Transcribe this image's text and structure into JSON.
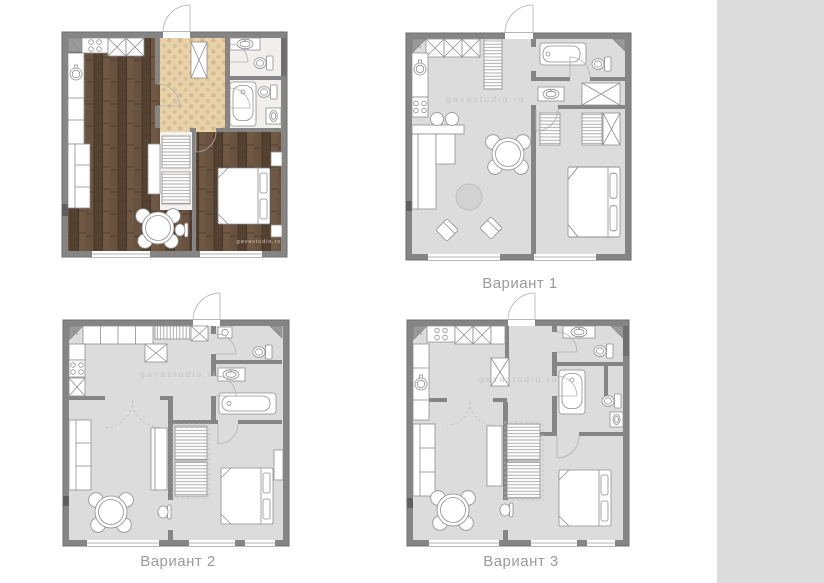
{
  "page": {
    "background": "#ffffff"
  },
  "plans": {
    "original": {
      "watermark": "gavastudio.ru"
    },
    "variant1": {
      "label": "Вариант 1",
      "watermark": "gavastudio.ru"
    },
    "variant2": {
      "label": "Вариант 2",
      "watermark": "gavastudio.ru"
    },
    "variant3": {
      "label": "Вариант 3",
      "watermark": "gavastudio.ru"
    }
  },
  "colors": {
    "wall": "#858585",
    "floor": "#dcdcdc",
    "wood": "#5e4936",
    "tile": "#e7d2aa",
    "label": "#9b9b9b",
    "wm": "#c4c4c4",
    "strip": "#dcdcdc"
  }
}
